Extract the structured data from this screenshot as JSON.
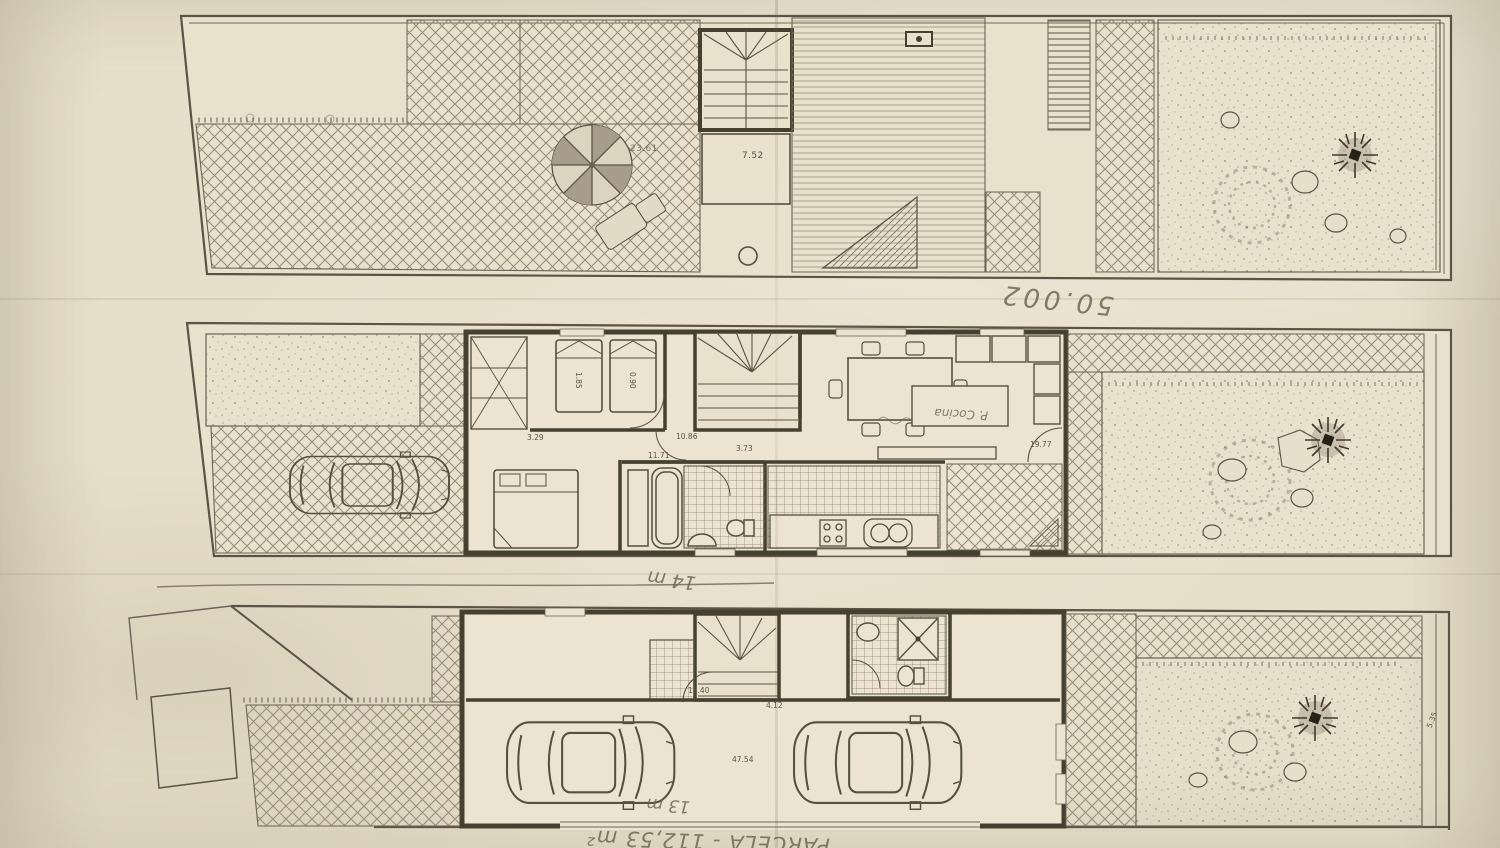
{
  "roof_plan": {
    "deck_area_label": "23.61",
    "stair_room_label": "7.52"
  },
  "main_plan": {
    "bedroom_dim_label": "3.29",
    "bed_length_label": "1.85",
    "bed_width_label": "0.90",
    "landing_label": "10.86",
    "hall_label": "11.71",
    "stair_hall_label": "3.73",
    "living_entry_label": "19.77",
    "kitchen_note": "P. Cocina"
  },
  "ground_plan": {
    "entry_label": "13.40",
    "hall_label": "4.12",
    "garage_label": "47.54",
    "garden_side_label": "5.35"
  },
  "handwritten_notes": {
    "note_between_plans": "50.002",
    "frontage_mid": "14 m",
    "frontage_bottom": "13 m",
    "parcel_note": "PARCELA - 112,53 m²"
  }
}
